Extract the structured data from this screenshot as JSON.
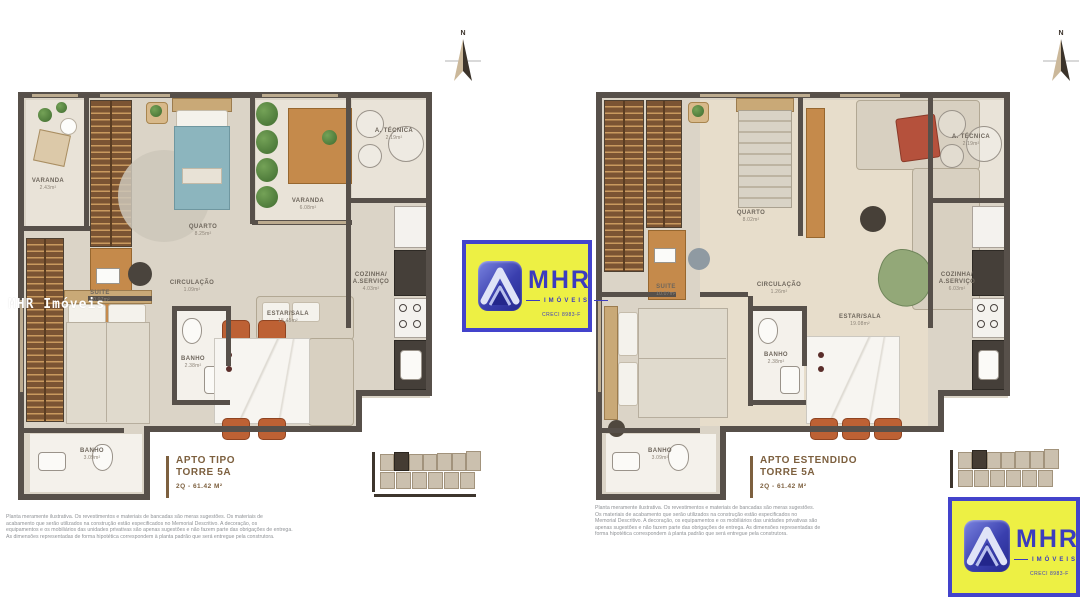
{
  "watermark": "MHR Imóveis",
  "compass_label": "N",
  "logo": {
    "brand": "MHR",
    "subtitle": "IMÓVEIS",
    "creci": "CRECI 8983-F"
  },
  "plans": {
    "left": {
      "title1": "APTO TIPO",
      "title2": "TORRE 5A",
      "area": "2Q - 61.42 M²",
      "rooms": {
        "varanda1": {
          "name": "VARANDA",
          "area": "2.43m²"
        },
        "quarto": {
          "name": "QUARTO",
          "area": "8.25m²"
        },
        "varanda2": {
          "name": "VARANDA",
          "area": "6.08m²"
        },
        "atecnica": {
          "name": "A. TÉCNICA",
          "area": "2.19m²"
        },
        "cozinha": {
          "name": "COZINHA/",
          "name2": "A.SERVIÇO",
          "area": "4.03m²"
        },
        "suite": {
          "name": "SUITE",
          "area": "10.07m²"
        },
        "circulacao": {
          "name": "CIRCULAÇÃO",
          "area": "1.09m²"
        },
        "estar": {
          "name": "ESTAR/SALA",
          "area": "15.45m²"
        },
        "banho1": {
          "name": "BANHO",
          "area": "2.38m²"
        },
        "banho2": {
          "name": "BANHO",
          "area": "3.09m²"
        }
      }
    },
    "right": {
      "title1": "APTO ESTENDIDO",
      "title2": "TORRE 5A",
      "area": "2Q - 61.42 M²",
      "rooms": {
        "quarto": {
          "name": "QUARTO",
          "area": "8.02m²"
        },
        "atecnica": {
          "name": "A. TÉCNICA",
          "area": "2.19m²"
        },
        "cozinha": {
          "name": "COZINHA/",
          "name2": "A.SERVIÇO",
          "area": "6.03m²"
        },
        "suite": {
          "name": "SUITE",
          "area": "10.07m²"
        },
        "circulacao": {
          "name": "CIRCULAÇÃO",
          "area": "1.26m²"
        },
        "estar": {
          "name": "ESTAR/SALA",
          "area": "19.08m²"
        },
        "banho1": {
          "name": "BANHO",
          "area": "2.38m²"
        },
        "banho2": {
          "name": "BANHO",
          "area": "3.09m²"
        }
      }
    }
  },
  "disclaimers": {
    "left": [
      "Planta meramente ilustrativa. Os revestimentos e materiais de bancadas são meras sugestões. Os materiais de",
      "acabamento que serão utilizados na construção estão especificados no Memorial Descritivo. A decoração, os",
      "equipamentos e os mobiliários das unidades privativas são apenas sugestões e não fazem parte das obrigações de entrega.",
      "As dimensões representadas de forma hipotética correspondem à planta padrão que será entregue pela construtora."
    ],
    "right": [
      "Planta meramente ilustrativa. Os revestimentos e materiais de bancadas são meras sugestões.",
      "Os materiais de acabamento que serão utilizados na construção estão especificados no",
      "Memorial Descritivo. A decoração, os equipamentos e os mobiliários das unidades privativas são",
      "apenas sugestões e não fazem parte das obrigações de entrega. As dimensões representadas de",
      "forma hipotética correspondem à planta padrão que será entregue pela construtora."
    ]
  }
}
